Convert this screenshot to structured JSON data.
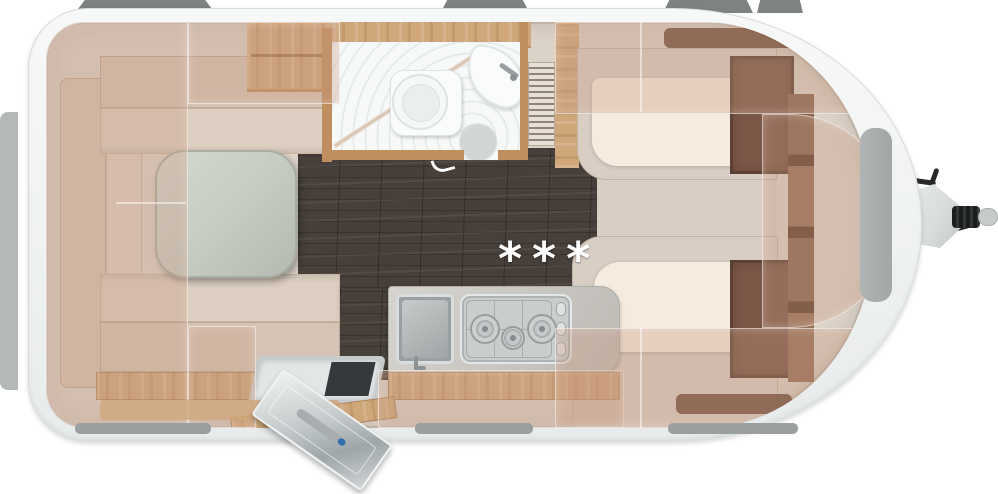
{
  "marker": {
    "text": "***"
  },
  "colors": {
    "body": "#f2f4f4",
    "body-edge": "#d9dcdc",
    "interior": "#dbd2c8",
    "floor": "#473f39",
    "wood": "#cfa77b",
    "wood-deep": "#bf8f60",
    "cushion": "#d5c4b6",
    "cushion-light": "#ddcfc1",
    "table": "#c9cec5",
    "mattress": "#f5ebdf",
    "platform": "#d8cec4",
    "counter": "#c8c5bf",
    "steel": "#c9cdcd",
    "steel-dark": "#9aa0a1",
    "wardrobe": "#7b5748",
    "wardrobe-dark": "#5e4134",
    "overlay": "#c7987f57",
    "window-top": "#7e8282",
    "window-bottom": "#9aa0a0",
    "porcelain": "#fafbfb",
    "hitch": "#27292a",
    "hitch-cover": "#d9dcdc",
    "door": "#c2c8c9",
    "marker-color": "#ffffff"
  }
}
